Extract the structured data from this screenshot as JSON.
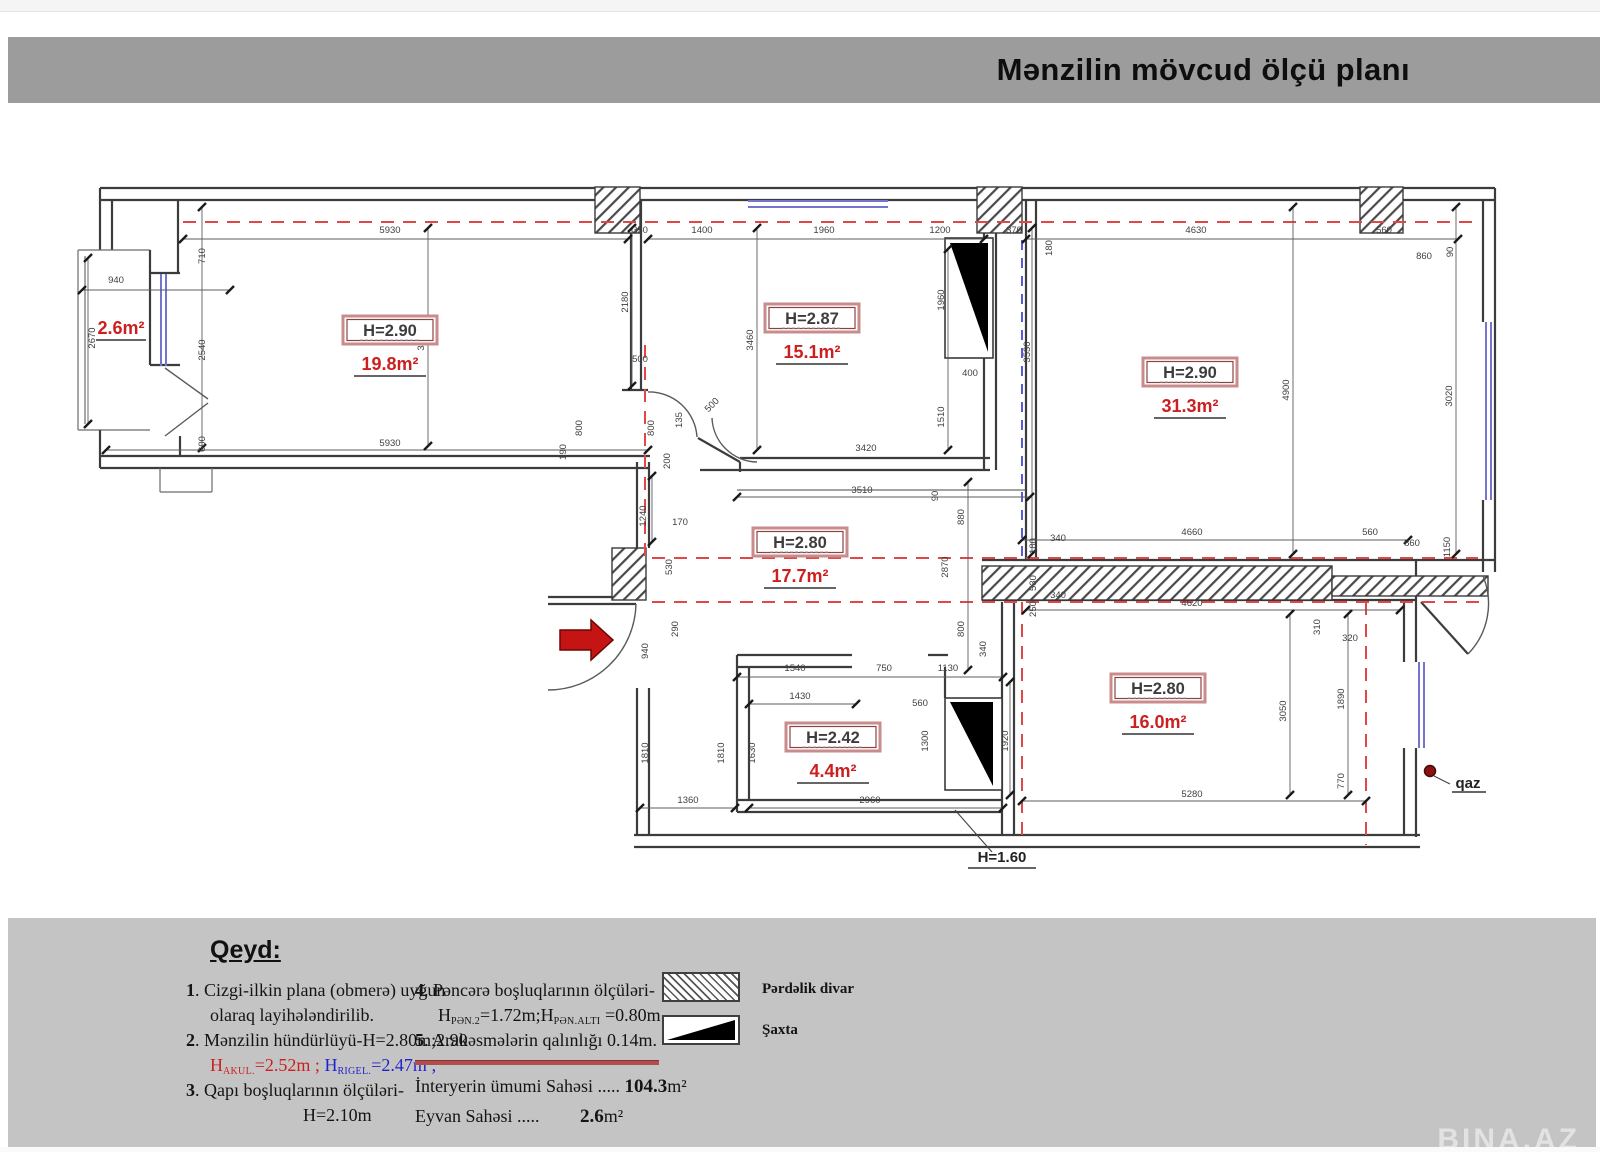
{
  "title": "Mənzilin mövcud ölçü planı",
  "watermark": "BINA.AZ",
  "plan": {
    "rooms": [
      {
        "h": "H=2.90",
        "area": "19.8m²"
      },
      {
        "h": "H=2.87",
        "area": "15.1m²"
      },
      {
        "h": "H=2.90",
        "area": "31.3m²"
      },
      {
        "h": "H=2.80",
        "area": "17.7m²"
      },
      {
        "h": "H=2.80",
        "area": "16.0m²"
      },
      {
        "h": "H=2.42",
        "area": "4.4m²"
      }
    ],
    "balcony_area": "2.6m²",
    "annotations": {
      "h160": "H=1.60",
      "qaz": "qaz"
    },
    "dims": [
      {
        "t": "5930",
        "x": 390,
        "y": 233,
        "r": 0
      },
      {
        "t": "350",
        "x": 640,
        "y": 233,
        "r": 0
      },
      {
        "t": "1400",
        "x": 702,
        "y": 233,
        "r": 0
      },
      {
        "t": "1960",
        "x": 824,
        "y": 233,
        "r": 0
      },
      {
        "t": "1200",
        "x": 940,
        "y": 233,
        "r": 0
      },
      {
        "t": "370",
        "x": 1014,
        "y": 233,
        "r": 0
      },
      {
        "t": "180",
        "x": 1052,
        "y": 248,
        "r": 90
      },
      {
        "t": "4630",
        "x": 1196,
        "y": 233,
        "r": 0
      },
      {
        "t": "560",
        "x": 1384,
        "y": 233,
        "r": 0
      },
      {
        "t": "860",
        "x": 1424,
        "y": 259,
        "r": 0
      },
      {
        "t": "90",
        "x": 1453,
        "y": 252,
        "r": 90
      },
      {
        "t": "940",
        "x": 116,
        "y": 283,
        "r": 0
      },
      {
        "t": "2670",
        "x": 95,
        "y": 338,
        "r": 90
      },
      {
        "t": "710",
        "x": 205,
        "y": 256,
        "r": 90
      },
      {
        "t": "2540",
        "x": 205,
        "y": 350,
        "r": 90
      },
      {
        "t": "600",
        "x": 205,
        "y": 444,
        "r": 90
      },
      {
        "t": "3350",
        "x": 424,
        "y": 340,
        "r": 90
      },
      {
        "t": "2180",
        "x": 628,
        "y": 302,
        "r": 90
      },
      {
        "t": "5930",
        "x": 390,
        "y": 446,
        "r": 0
      },
      {
        "t": "500",
        "x": 640,
        "y": 362,
        "r": 0
      },
      {
        "t": "800",
        "x": 582,
        "y": 428,
        "r": 90
      },
      {
        "t": "800",
        "x": 654,
        "y": 428,
        "r": 90
      },
      {
        "t": "135",
        "x": 682,
        "y": 420,
        "r": 90
      },
      {
        "t": "200",
        "x": 670,
        "y": 461,
        "r": 90
      },
      {
        "t": "500",
        "x": 714,
        "y": 407,
        "r": 45
      },
      {
        "t": "190",
        "x": 566,
        "y": 452,
        "r": 90
      },
      {
        "t": "3460",
        "x": 753,
        "y": 340,
        "r": 90
      },
      {
        "t": "1960",
        "x": 944,
        "y": 300,
        "r": 90
      },
      {
        "t": "400",
        "x": 970,
        "y": 376,
        "r": 0
      },
      {
        "t": "1510",
        "x": 944,
        "y": 417,
        "r": 90
      },
      {
        "t": "3420",
        "x": 866,
        "y": 451,
        "r": 0
      },
      {
        "t": "3510",
        "x": 862,
        "y": 493,
        "r": 0
      },
      {
        "t": "90",
        "x": 938,
        "y": 496,
        "r": 90
      },
      {
        "t": "3530",
        "x": 1030,
        "y": 352,
        "r": 90
      },
      {
        "t": "4900",
        "x": 1289,
        "y": 390,
        "r": 90
      },
      {
        "t": "3020",
        "x": 1452,
        "y": 396,
        "r": 90
      },
      {
        "t": "1240",
        "x": 646,
        "y": 516,
        "r": 90
      },
      {
        "t": "170",
        "x": 680,
        "y": 525,
        "r": 0
      },
      {
        "t": "530",
        "x": 672,
        "y": 567,
        "r": 90
      },
      {
        "t": "290",
        "x": 678,
        "y": 629,
        "r": 90
      },
      {
        "t": "940",
        "x": 648,
        "y": 651,
        "r": 90
      },
      {
        "t": "880",
        "x": 964,
        "y": 517,
        "r": 90
      },
      {
        "t": "2870",
        "x": 948,
        "y": 567,
        "r": 90
      },
      {
        "t": "180",
        "x": 1036,
        "y": 546,
        "r": 90
      },
      {
        "t": "530",
        "x": 1036,
        "y": 583,
        "r": 90
      },
      {
        "t": "250",
        "x": 1036,
        "y": 609,
        "r": 90
      },
      {
        "t": "340",
        "x": 1058,
        "y": 541,
        "r": 0
      },
      {
        "t": "340",
        "x": 1058,
        "y": 598,
        "r": 0
      },
      {
        "t": "800",
        "x": 964,
        "y": 629,
        "r": 90
      },
      {
        "t": "340",
        "x": 986,
        "y": 649,
        "r": 90
      },
      {
        "t": "4660",
        "x": 1192,
        "y": 535,
        "r": 0
      },
      {
        "t": "560",
        "x": 1370,
        "y": 535,
        "r": 0
      },
      {
        "t": "860",
        "x": 1412,
        "y": 546,
        "r": 0
      },
      {
        "t": "1150",
        "x": 1450,
        "y": 547,
        "r": 90
      },
      {
        "t": "4620",
        "x": 1192,
        "y": 606,
        "r": 0
      },
      {
        "t": "310",
        "x": 1320,
        "y": 627,
        "r": 90
      },
      {
        "t": "320",
        "x": 1350,
        "y": 641,
        "r": 0
      },
      {
        "t": "1540",
        "x": 795,
        "y": 671,
        "r": 0
      },
      {
        "t": "750",
        "x": 884,
        "y": 671,
        "r": 0
      },
      {
        "t": "1130",
        "x": 948,
        "y": 671,
        "r": 0
      },
      {
        "t": "1430",
        "x": 800,
        "y": 699,
        "r": 0
      },
      {
        "t": "560",
        "x": 920,
        "y": 706,
        "r": 0
      },
      {
        "t": "1630",
        "x": 755,
        "y": 753,
        "r": 90
      },
      {
        "t": "1810",
        "x": 724,
        "y": 753,
        "r": 90
      },
      {
        "t": "1810",
        "x": 648,
        "y": 753,
        "r": 90
      },
      {
        "t": "1300",
        "x": 928,
        "y": 741,
        "r": 90
      },
      {
        "t": "1920",
        "x": 1008,
        "y": 741,
        "r": 90
      },
      {
        "t": "1360",
        "x": 688,
        "y": 803,
        "r": 0
      },
      {
        "t": "2960",
        "x": 870,
        "y": 803,
        "r": 0
      },
      {
        "t": "3050",
        "x": 1286,
        "y": 711,
        "r": 90
      },
      {
        "t": "1890",
        "x": 1344,
        "y": 699,
        "r": 90
      },
      {
        "t": "770",
        "x": 1344,
        "y": 781,
        "r": 90
      },
      {
        "t": "5280",
        "x": 1192,
        "y": 797,
        "r": 0
      }
    ]
  },
  "legend": {
    "hatch_label": "Pərdəlik divar",
    "shaft_label": "Şaxta"
  },
  "notes": {
    "heading": "Qeyd:",
    "n1a": "1",
    "n1b": ". Cizgi-ilkin plana (obmerə) uyğun",
    "n1c": "olaraq layihələndirilib.",
    "n2a": "2",
    "n2b": ". Mənzilin hündürlüyü-H=2.80m;2.90",
    "n2r1": "H",
    "n2r2": "AKUL.",
    "n2r3": "=2.52m ;",
    "n2b1": "H",
    "n2b2": "RIGEL.",
    "n2b3": "=2.47m ;",
    "n3a": "3",
    "n3b": ". Qapı boşluqlarının ölçüləri-",
    "n3c": "H=2.10m",
    "n4a": "4",
    "n4b": ". Pəncərə boşluqlarının ölçüləri-",
    "n4s1": "H",
    "n4s2": "PƏN.2",
    "n4s3": "=1.72m;",
    "n4s4": "H",
    "n4s5": "PƏN.ALTI",
    "n4s6": "=0.80m",
    "n5a": "5",
    "n5b": ". Arakəsmələrin qalınlığı 0.14m."
  },
  "totals": {
    "t1_label": "İnteryerin ümumi Sahəsi .....",
    "t1_value": "104.3",
    "t1_unit": "m²",
    "t2_label": "Eyvan Sahəsi .....",
    "t2_value": "2.6",
    "t2_unit": "m²"
  }
}
